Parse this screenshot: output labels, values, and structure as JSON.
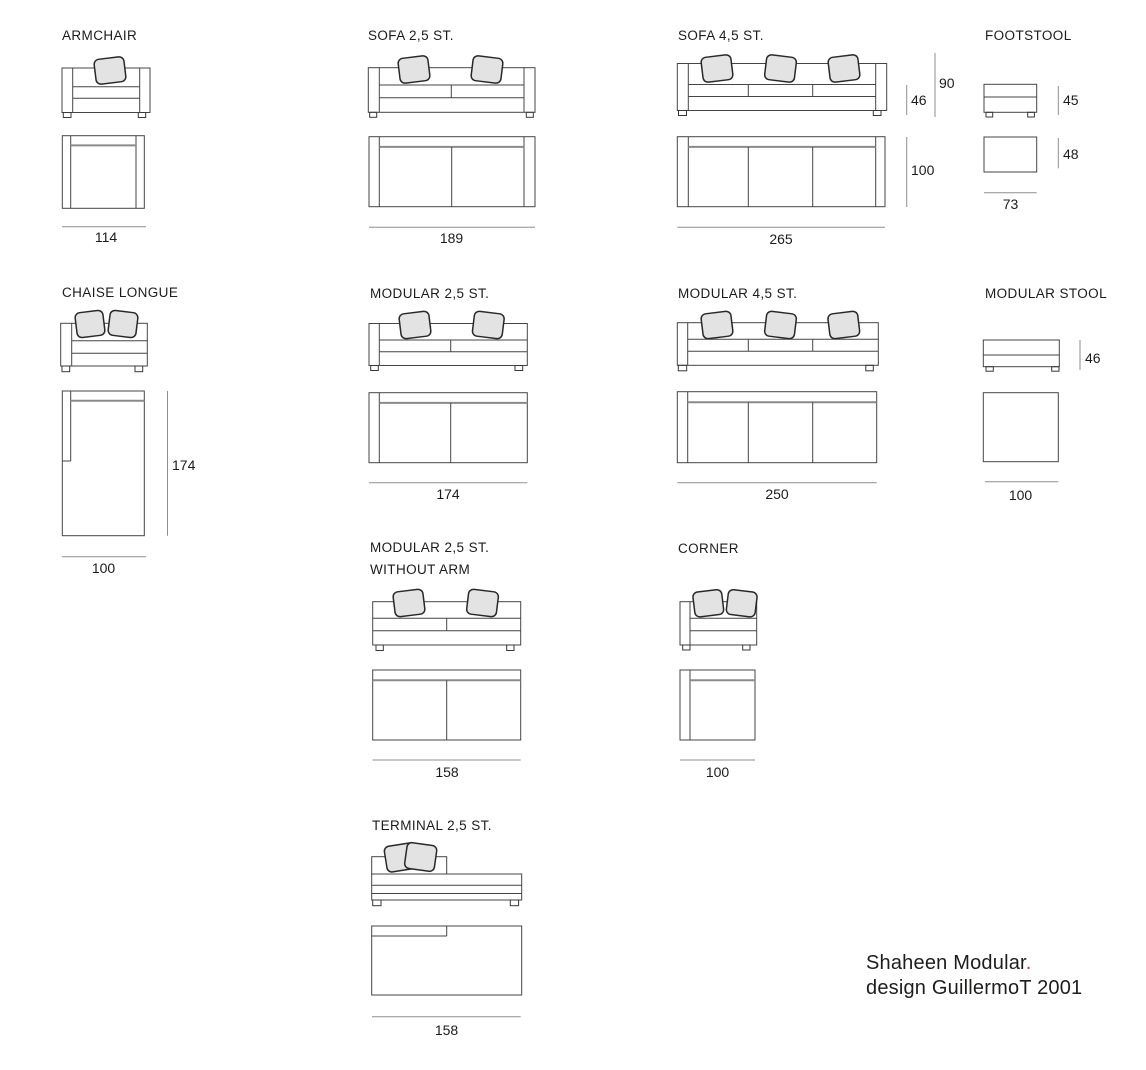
{
  "items": {
    "armchair": {
      "label": "ARMCHAIR",
      "width": "114"
    },
    "sofa_25": {
      "label": "SOFA 2,5 ST.",
      "width": "189"
    },
    "sofa_45": {
      "label": "SOFA 4,5 ST.",
      "width": "265",
      "seat_height": "46",
      "total_height": "90",
      "depth": "100"
    },
    "footstool": {
      "label": "FOOTSTOOL",
      "height": "45",
      "depth": "48",
      "width": "73"
    },
    "chaise_longue": {
      "label": "CHAISE LONGUE",
      "length": "174",
      "width": "100"
    },
    "modular_25": {
      "label": "MODULAR 2,5 ST.",
      "width": "174"
    },
    "modular_45": {
      "label": "MODULAR 4,5 ST.",
      "width": "250"
    },
    "modular_stool": {
      "label": "MODULAR STOOL",
      "height": "46",
      "width": "100"
    },
    "modular_25_without_arm": {
      "label_line1": "MODULAR 2,5 ST.",
      "label_line2": "WITHOUT ARM",
      "width": "158"
    },
    "corner": {
      "label": "CORNER",
      "width": "100"
    },
    "terminal_25": {
      "label": "TERMINAL 2,5 ST.",
      "width": "158"
    }
  },
  "footer": {
    "product_name": "Shaheen Modular",
    "period": ".",
    "design_credit": "design GuillermoT 2001"
  },
  "colors": {
    "accent_red": "#c43b3b",
    "line": "#454545",
    "dimension_line": "#8f8f8f",
    "cushion_fill": "#e3e3e3",
    "background": "#ffffff"
  }
}
